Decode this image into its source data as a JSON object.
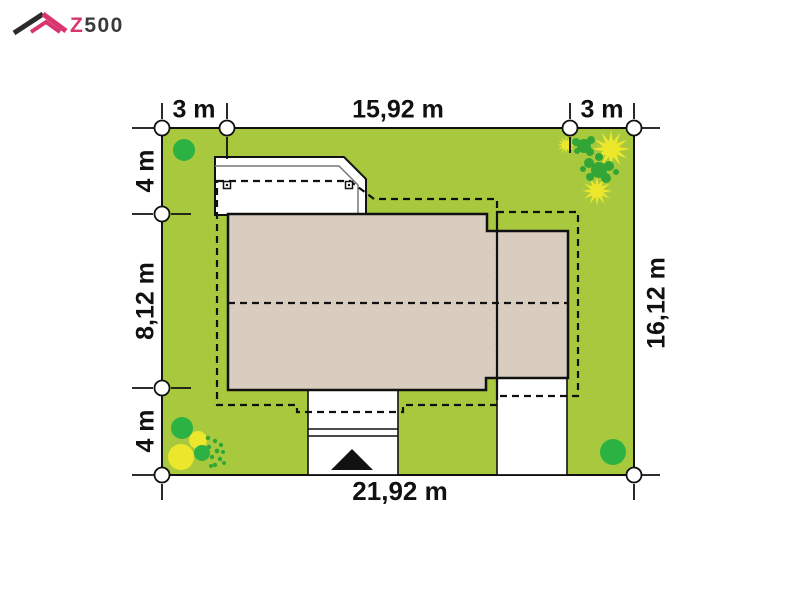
{
  "logo": {
    "brand_z": "Z",
    "brand_rest": "500"
  },
  "plot": {
    "dim_top": [
      "3 m",
      "15,92 m",
      "3 m"
    ],
    "dim_left": [
      "4 m",
      "8,12 m",
      "4 m"
    ],
    "dim_right": "16,12 m",
    "dim_bottom": "21,92 m"
  },
  "icons": {
    "entrance_triangle": "▲"
  },
  "colors": {
    "grass": "#a8c93e",
    "tree_green": "#2cb143",
    "splat_green": "#31a637",
    "bush_yellow": "#ede72c",
    "house_beige": "#d9cdc0",
    "white": "#ffffff",
    "line_black": "#111111",
    "inner_line_gray": "#777777",
    "logo_pink": "#d8356f",
    "logo_dark": "#3a3a3e"
  }
}
